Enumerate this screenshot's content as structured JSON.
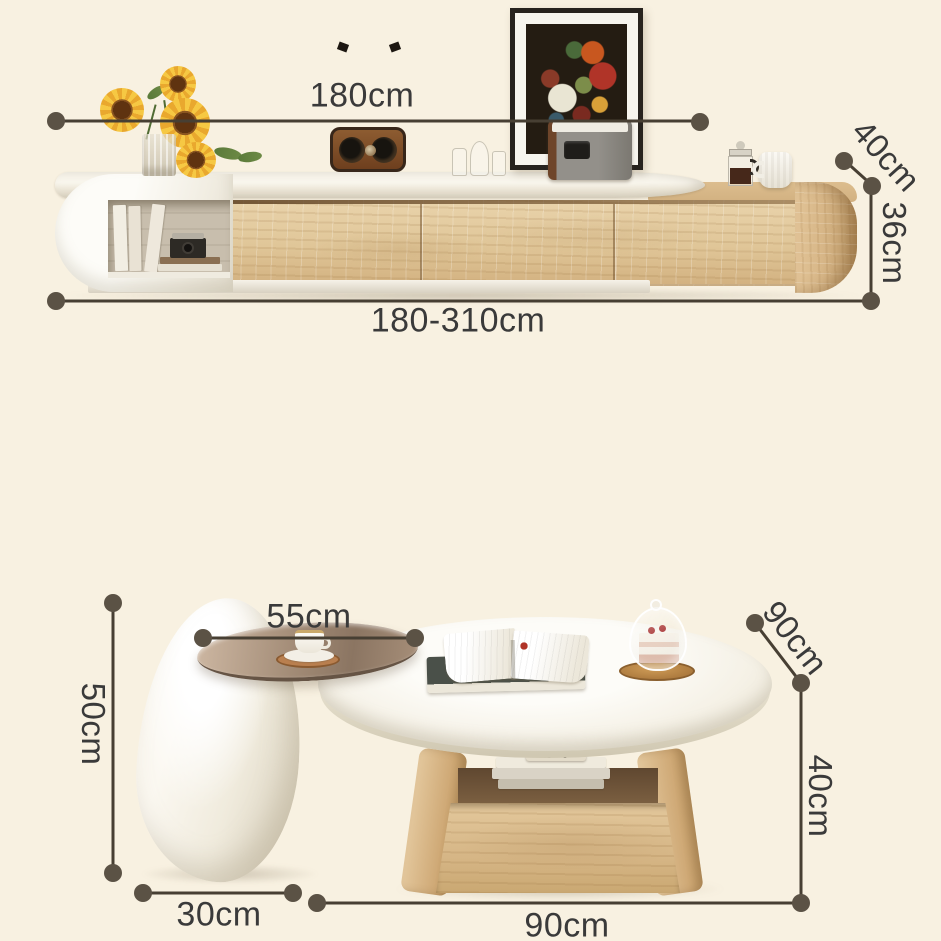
{
  "scene": {
    "background_color": "#f8f1e1",
    "annotation_line_color": "#473f33",
    "annotation_dot_color": "#5b5245",
    "label_text_color": "#3a3a3a",
    "wood_color": "#ddc092",
    "shell_color": "#f6f2e8"
  },
  "dims": {
    "tv_top_width": "180cm",
    "tv_total_width": "180-310cm",
    "tv_depth": "40cm",
    "tv_height": "36cm",
    "side_tray_width": "55cm",
    "side_height": "50cm",
    "side_base_width": "30cm",
    "table_depth": "90cm",
    "table_height": "40cm",
    "table_width": "90cm"
  }
}
